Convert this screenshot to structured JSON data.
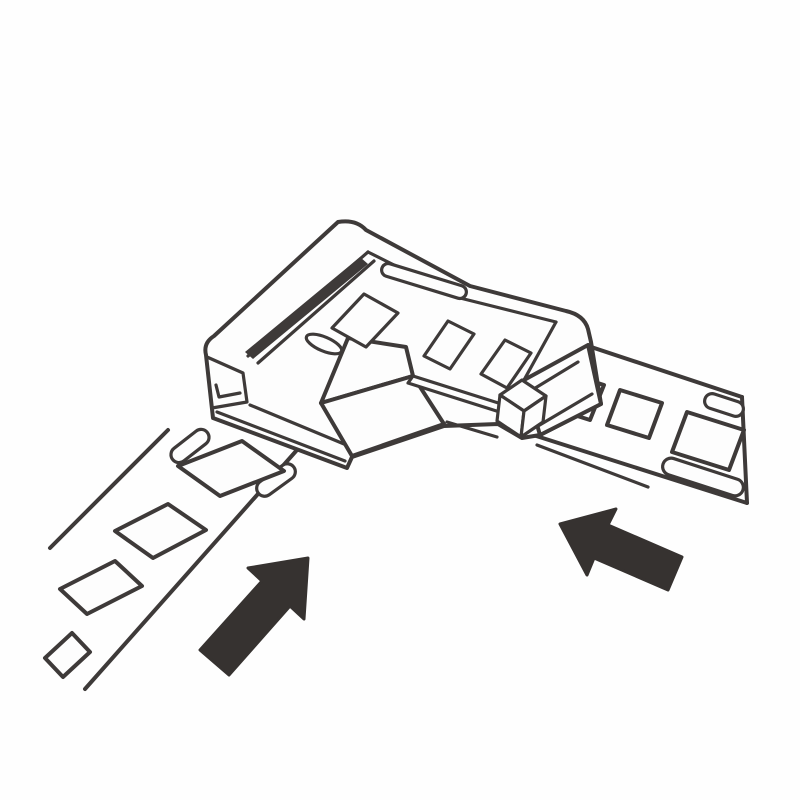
{
  "figure": {
    "title": "LED strip corner connector installation diagram",
    "kind": "monochrome line-art instruction illustration",
    "colors": {
      "background": "#fefefe",
      "paper": "#fdfdfd",
      "line": "#3e3a39",
      "arrow": "#363230"
    },
    "parts": [
      {
        "id": "corner-connector",
        "meaning": "L-shaped clip-on corner connector shown in isometric view with recessed tray, center block, contact windows, oval hole and strip channels"
      },
      {
        "id": "led-strip-left",
        "meaning": "LED strip sliding in from lower left",
        "pad_count": 4,
        "end_notch_count": 2
      },
      {
        "id": "led-strip-right",
        "meaning": "LED strip sliding in from right",
        "pad_count": 3,
        "end_notch_count": 2
      },
      {
        "id": "insertion-arrow-left",
        "meaning": "solid arrow pointing up-right: push left strip into connector"
      },
      {
        "id": "insertion-arrow-right",
        "meaning": "solid arrow pointing left: push right strip into connector"
      }
    ]
  }
}
